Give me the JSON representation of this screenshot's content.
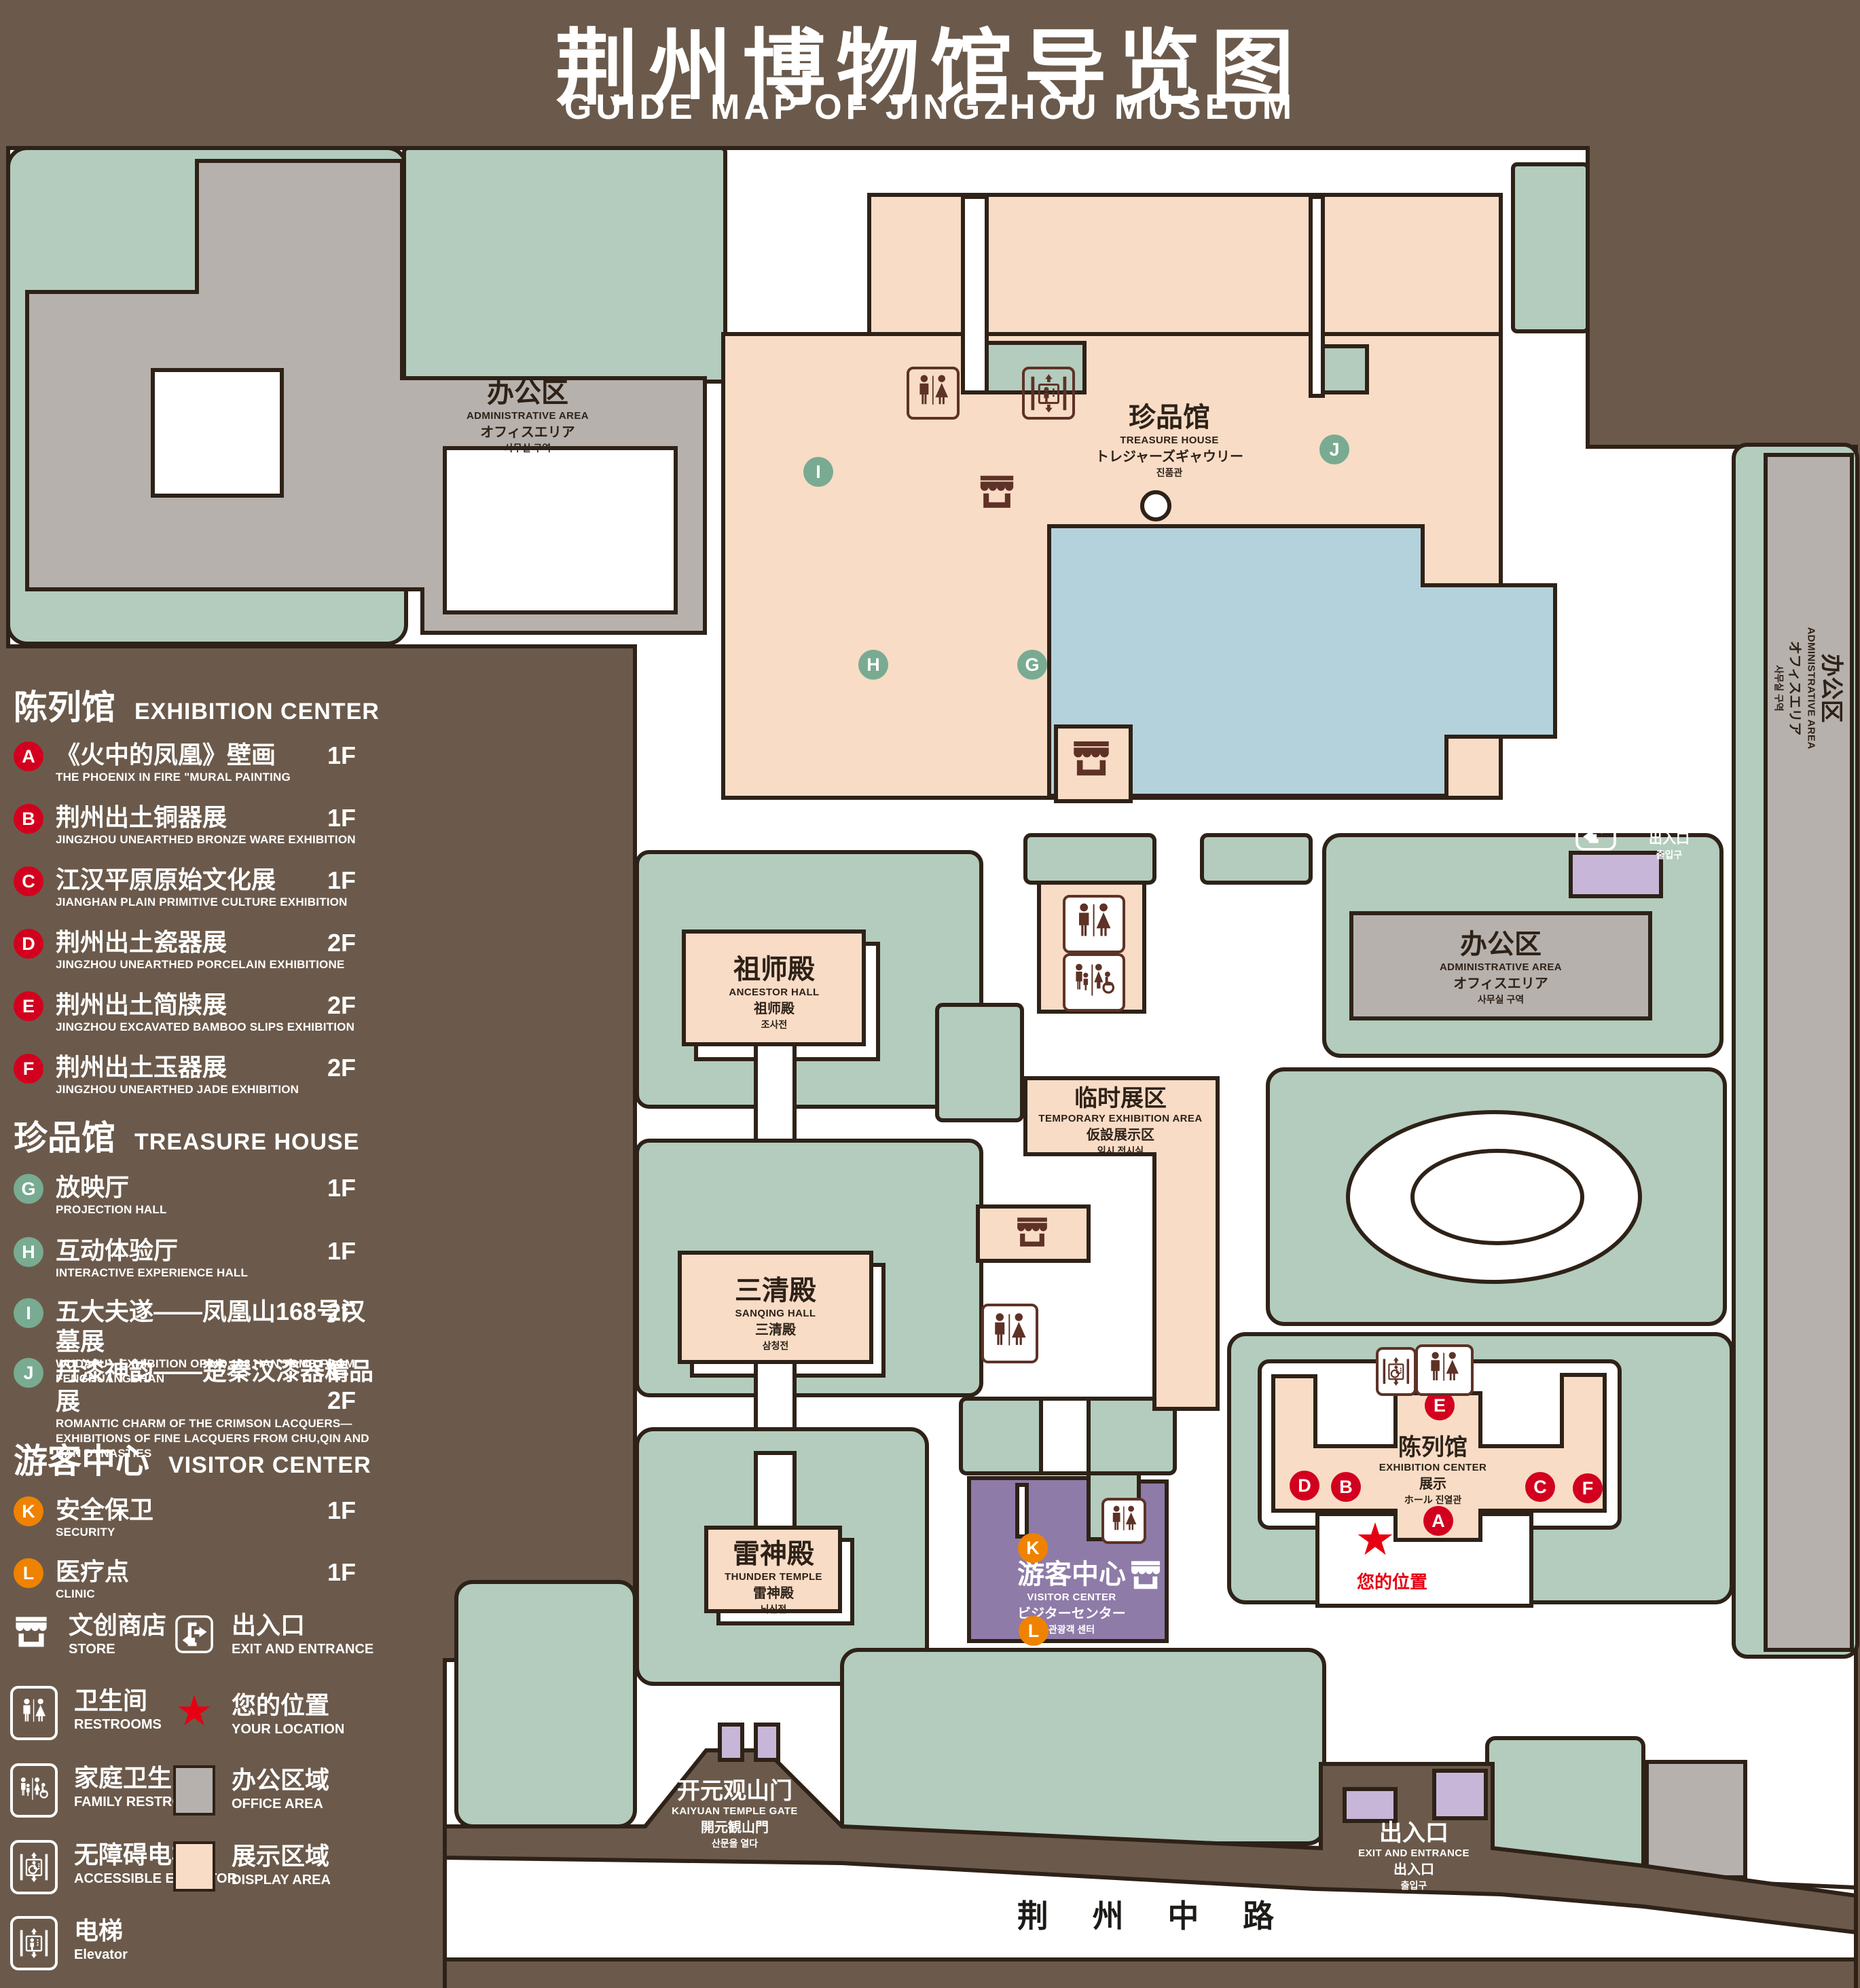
{
  "title": {
    "zh": "荆州博物馆导览图",
    "en": "GUIDE MAP OF JINGZHOU MUSEUM"
  },
  "legend": {
    "sections": [
      {
        "zh": "陈列馆",
        "en": "EXHIBITION CENTER",
        "items": [
          {
            "letter": "A",
            "zh": "《火中的凤凰》壁画",
            "en": "THE PHOENIX IN FIRE \"MURAL PAINTING",
            "floor": "1F"
          },
          {
            "letter": "B",
            "zh": "荆州出土铜器展",
            "en": "JINGZHOU UNEARTHED BRONZE WARE EXHIBITION",
            "floor": "1F"
          },
          {
            "letter": "C",
            "zh": "江汉平原原始文化展",
            "en": "JIANGHAN PLAIN PRIMITIVE CULTURE EXHIBITION",
            "floor": "1F"
          },
          {
            "letter": "D",
            "zh": "荆州出土瓷器展",
            "en": "JINGZHOU UNEARTHED PORCELAIN EXHIBITIONE",
            "floor": "2F"
          },
          {
            "letter": "E",
            "zh": "荆州出土简牍展",
            "en": "JINGZHOU EXCAVATED BAMBOO SLIPS EXHIBITION",
            "floor": "2F"
          },
          {
            "letter": "F",
            "zh": "荆州出土玉器展",
            "en": "JINGZHOU UNEARTHED JADE EXHIBITION",
            "floor": "2F"
          }
        ]
      },
      {
        "zh": "珍品馆",
        "en": "TREASURE HOUSE",
        "items": [
          {
            "letter": "G",
            "zh": "放映厅",
            "en": "PROJECTION HALL",
            "floor": "1F"
          },
          {
            "letter": "H",
            "zh": "互动体验厅",
            "en": "INTERACTIVE EXPERIENCE HALL",
            "floor": "1F"
          },
          {
            "letter": "I",
            "zh": "五大夫遂——凤凰山168号汉墓展",
            "en": "WUDAFU—EXHIBITION OF NO.168 HAN TOMB FROM FENGHUANGSHAN",
            "floor": "2F"
          },
          {
            "letter": "J",
            "zh": "丹漆神韵——楚秦汉漆器精品展",
            "en": "ROMANTIC CHARM OF THE CRIMSON LACQUERS—EXHIBITIONS OF FINE LACQUERS FROM CHU,QIN AND HAN DYNASTIES",
            "floor": "1-2F"
          }
        ]
      },
      {
        "zh": "游客中心",
        "en": "VISITOR CENTER",
        "items": [
          {
            "letter": "K",
            "zh": "安全保卫",
            "en": "SECURITY",
            "floor": "1F"
          },
          {
            "letter": "L",
            "zh": "医疗点",
            "en": "CLINIC",
            "floor": "1F"
          }
        ]
      }
    ],
    "symbols": {
      "store": {
        "zh": "文创商店",
        "en": "STORE"
      },
      "exit": {
        "zh": "出入口",
        "en": "EXIT AND ENTRANCE"
      },
      "restrooms": {
        "zh": "卫生间",
        "en": "RESTROOMS"
      },
      "location": {
        "zh": "您的位置",
        "en": "YOUR LOCATION"
      },
      "family": {
        "zh": "家庭卫生间",
        "en": "FAMILY RESTROOMS"
      },
      "office": {
        "zh": "办公区域",
        "en": "OFFICE AREA"
      },
      "accessible": {
        "zh": "无障碍电梯",
        "en": "ACCESSIBLE ELEVATOR"
      },
      "display": {
        "zh": "展示区域",
        "en": "DISPLAY AREA"
      },
      "elevator": {
        "zh": "电梯",
        "en": "Elevator"
      }
    }
  },
  "map": {
    "admin": {
      "zh": "办公区",
      "en": "ADMINISTRATIVE AREA",
      "jp": "オフィスエリア",
      "kr": "사무실 구역"
    },
    "treasure": {
      "zh": "珍品馆",
      "en": "TREASURE HOUSE",
      "jp": "トレジャーズギャウリー",
      "kr": "진품관"
    },
    "ancestor": {
      "zh": "祖师殿",
      "en": "ANCESTOR HALL",
      "jp": "祖师殿",
      "kr": "조사전"
    },
    "temporary": {
      "zh": "临时展区",
      "en": "TEMPORARY EXHIBITION AREA",
      "jp": "仮設展示区",
      "kr": "임시 전시실"
    },
    "sanqing": {
      "zh": "三清殿",
      "en": "SANQING HALL",
      "jp": "三清殿",
      "kr": "삼청전"
    },
    "thunder": {
      "zh": "雷神殿",
      "en": "THUNDER TEMPLE",
      "jp": "雷神殿",
      "kr": "뇌신전"
    },
    "visitor": {
      "zh": "游客中心",
      "en": "VISITOR CENTER",
      "jp": "ビジターセンター",
      "kr": "관광객 센터"
    },
    "exhibition": {
      "zh": "陈列馆",
      "en": "EXHIBITION CENTER",
      "jp": "展示",
      "kr": "ホール 진열관"
    },
    "gate": {
      "zh": "开元观山门",
      "en": "KAIYUAN TEMPLE GATE",
      "jp": "開元観山門",
      "kr": "산문을 열다"
    },
    "exit": {
      "zh": "出入口",
      "en": "EXIT AND ENTRANCE",
      "jp": "出入口",
      "kr": "출입구"
    },
    "your_location": "您的位置",
    "road": "荆 州 中 路",
    "markers": {
      "A": "A",
      "B": "B",
      "C": "C",
      "D": "D",
      "E": "E",
      "F": "F",
      "G": "G",
      "H": "H",
      "I": "I",
      "J": "J",
      "K": "K",
      "L": "L"
    }
  },
  "colors": {
    "background": "#6B5A4B",
    "campus_green": "#B3CCBD",
    "display_pink": "#F8DCC6",
    "office_gray": "#B7B1AD",
    "lake_blue": "#B4D2DC",
    "visitor_purple": "#8E7BA8",
    "entrance_lavender": "#C8B6D8",
    "marker_red": "#D2001E",
    "marker_green": "#79AB92",
    "marker_orange": "#EF8200",
    "location_red": "#E60012",
    "outline": "#2E2218"
  }
}
